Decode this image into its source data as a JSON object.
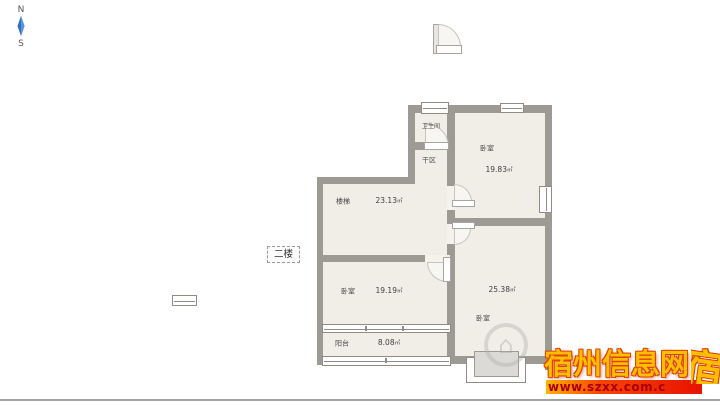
{
  "compass": {
    "north": "N",
    "south": "S"
  },
  "floor_tag": {
    "label": "二楼"
  },
  "plan": {
    "rooms": {
      "bathroom": {
        "name": "卫生间"
      },
      "dry_area": {
        "name": "干区"
      },
      "bedroom_ne": {
        "name": "卧室",
        "area": "19.83",
        "unit": "㎡"
      },
      "stairs": {
        "name": "楼梯",
        "area": "23.13",
        "unit": "㎡"
      },
      "bedroom_w": {
        "name": "卧室",
        "area": "19.19",
        "unit": "㎡"
      },
      "bedroom_se": {
        "name": "卧室",
        "area": "25.38",
        "unit": "㎡"
      },
      "balcony": {
        "name": "阳台",
        "area": "8.08",
        "unit": "㎡"
      }
    },
    "logo_glyph": "⌂"
  },
  "watermark": {
    "site_name": "宿州信息网",
    "url": "www.szxx.com.c",
    "edge_fragment": "宿"
  },
  "colors": {
    "wall": "#9d9a94",
    "room_fill": "#f1eee8",
    "window_frame": "#8f8c86",
    "compass_blue": "#2f6fc1",
    "watermark_yellow": "#ffbe00",
    "watermark_red_outline": "#e04000",
    "url_bar_start": "#ffb400",
    "url_bar_end": "#e81200",
    "url_text": "#a80000"
  }
}
